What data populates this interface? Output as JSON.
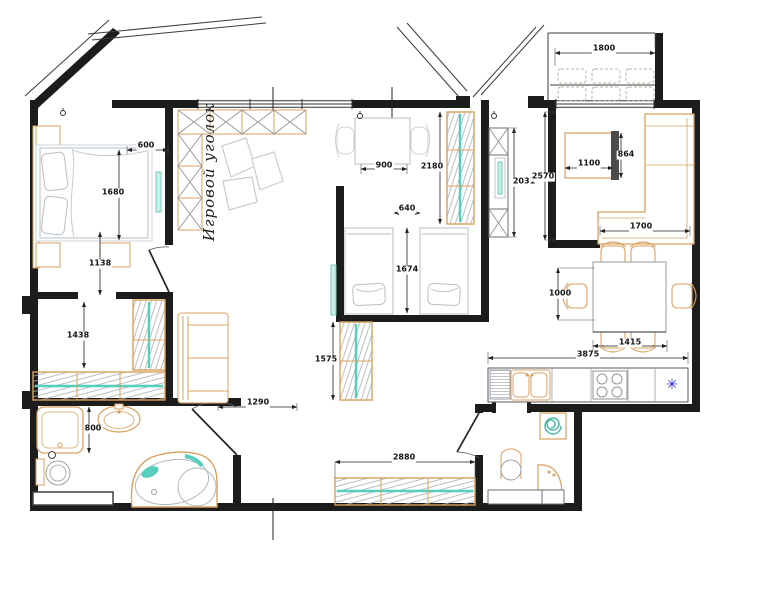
{
  "plan": {
    "title": "Apartment floor plan"
  },
  "colors": {
    "wall": "#1c1c1c",
    "furniture_accent": "#d9a15f",
    "teal_accent": "#57cfbd",
    "bed_outline": "#b6bfc7",
    "fridge_blue": "#1b1be4",
    "background": "#ffffff"
  },
  "room_labels": [
    {
      "name": "play-corner-label",
      "text": "Игровой уголок",
      "x": 209,
      "y": 172,
      "rotate": -90
    }
  ],
  "dimensions": [
    {
      "text": "600",
      "x": 146,
      "y": 146
    },
    {
      "text": "1680",
      "x": 113,
      "y": 193
    },
    {
      "text": "1138",
      "x": 100,
      "y": 264
    },
    {
      "text": "1438",
      "x": 78,
      "y": 336
    },
    {
      "text": "800",
      "x": 93,
      "y": 429
    },
    {
      "text": "900",
      "x": 384,
      "y": 166
    },
    {
      "text": "2180",
      "x": 432,
      "y": 167
    },
    {
      "text": "640",
      "x": 407,
      "y": 209
    },
    {
      "text": "1674",
      "x": 407,
      "y": 270
    },
    {
      "text": "1575",
      "x": 326,
      "y": 360
    },
    {
      "text": "1290",
      "x": 258,
      "y": 403
    },
    {
      "text": "2880",
      "x": 404,
      "y": 458
    },
    {
      "text": "2031",
      "x": 524,
      "y": 182
    },
    {
      "text": "2570",
      "x": 543,
      "y": 177
    },
    {
      "text": "1100",
      "x": 589,
      "y": 164
    },
    {
      "text": "864",
      "x": 626,
      "y": 155
    },
    {
      "text": "1700",
      "x": 641,
      "y": 227
    },
    {
      "text": "1800",
      "x": 604,
      "y": 49
    },
    {
      "text": "1000",
      "x": 560,
      "y": 294
    },
    {
      "text": "1415",
      "x": 630,
      "y": 343
    },
    {
      "text": "3875",
      "x": 588,
      "y": 355
    }
  ],
  "icons": [
    {
      "name": "fridge-icon",
      "glyph": "✳",
      "x": 672,
      "y": 385,
      "color": "#1b1be4",
      "size": 14
    }
  ]
}
